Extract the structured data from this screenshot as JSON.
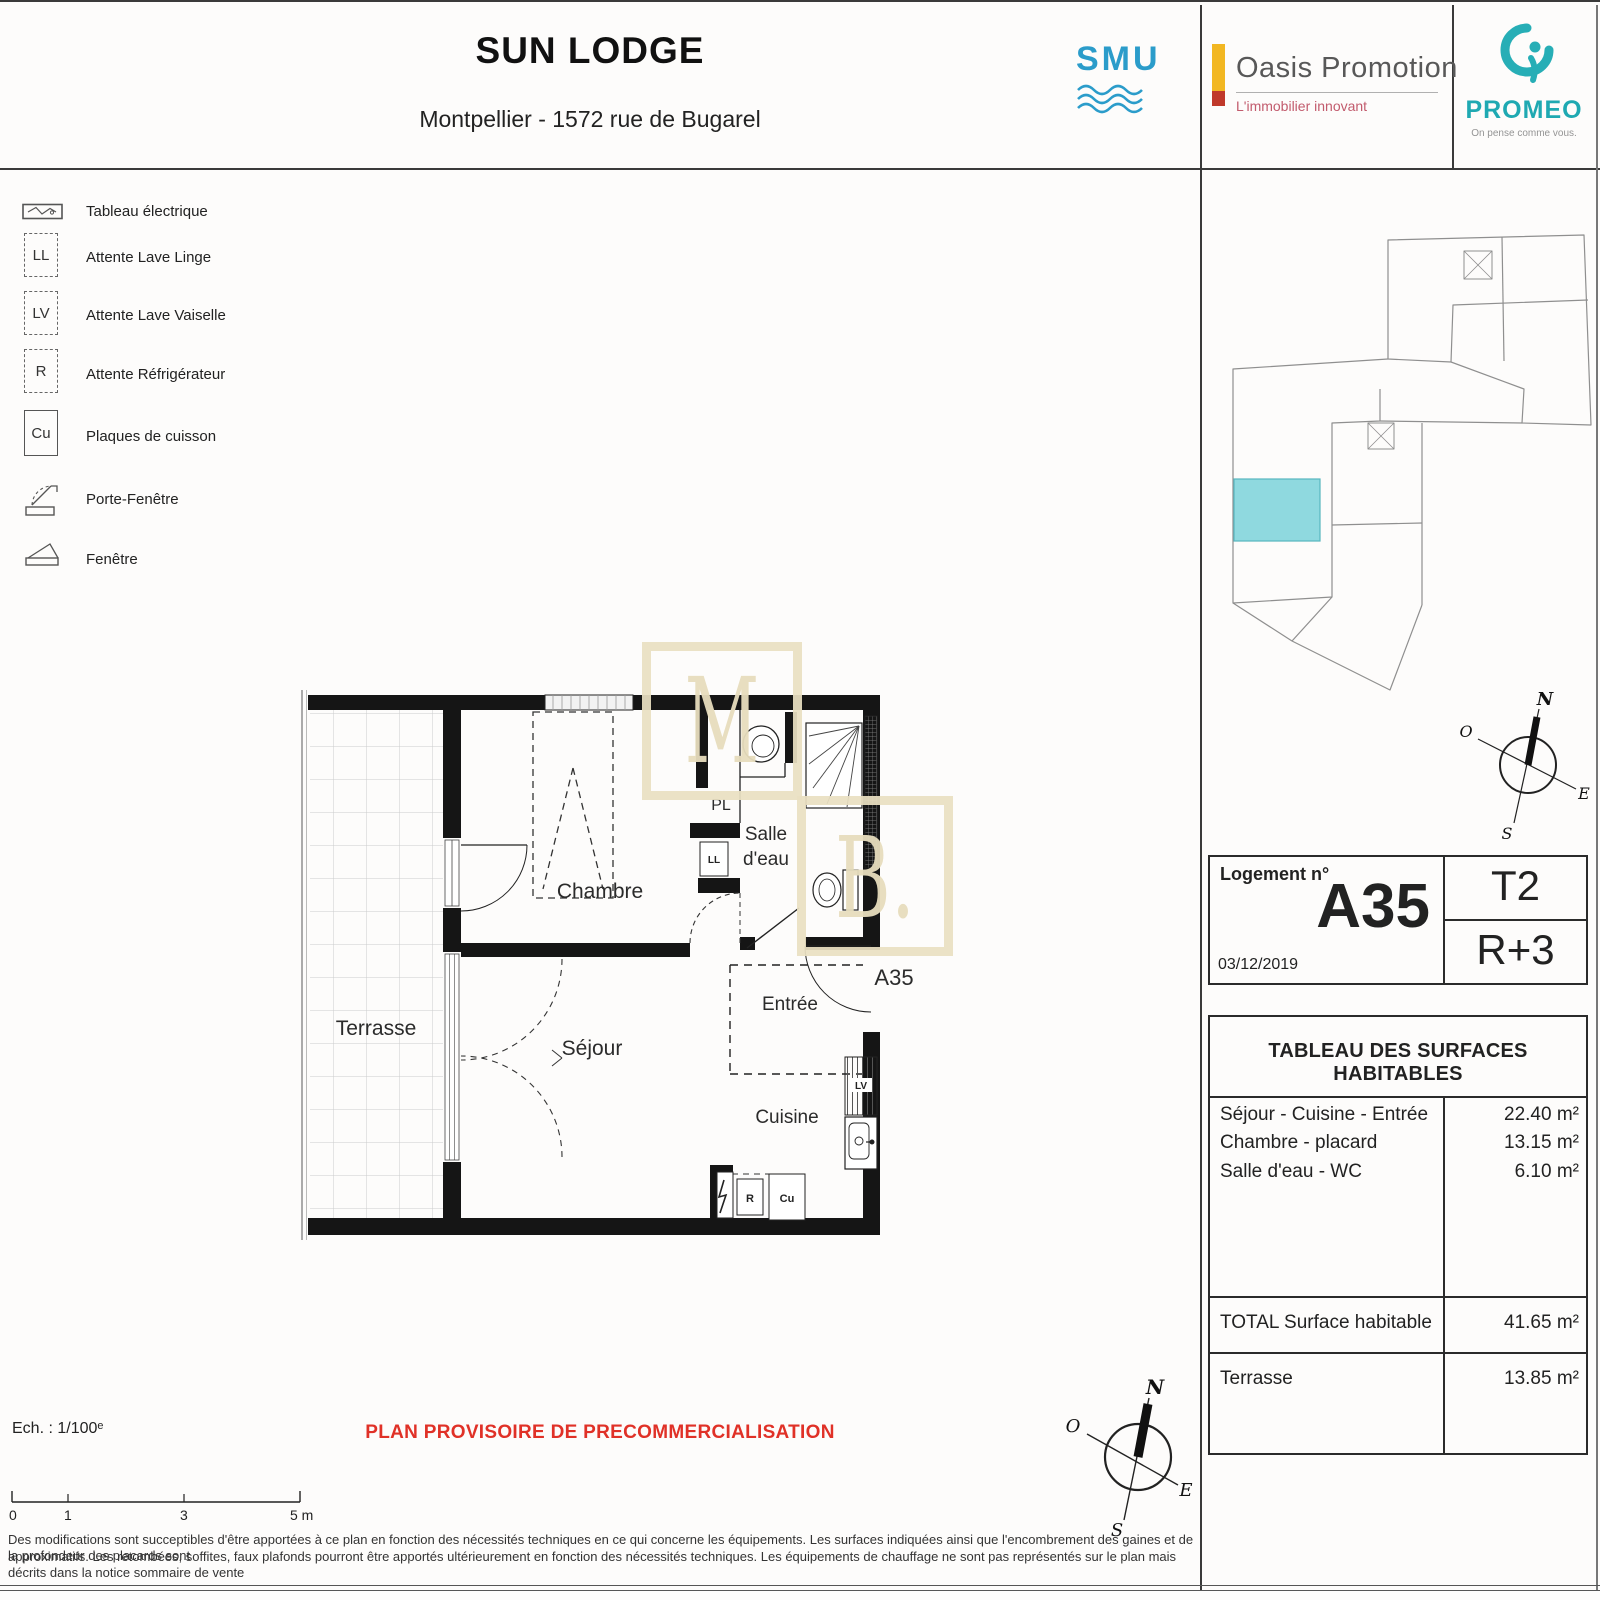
{
  "header": {
    "title": "SUN LODGE",
    "subtitle": "Montpellier  - 1572 rue de Bugarel"
  },
  "logos": {
    "smu": {
      "text": "SMU"
    },
    "oasis": {
      "name": "Oasis Promotion",
      "tagline": "L'immobilier innovant"
    },
    "promeo": {
      "name": "PROMEO",
      "tagline": "On pense comme vous."
    }
  },
  "legend": {
    "items": [
      {
        "box": "",
        "label": "Tableau électrique"
      },
      {
        "box": "LL",
        "label": "Attente Lave Linge"
      },
      {
        "box": "LV",
        "label": "Attente Lave Vaiselle"
      },
      {
        "box": "R",
        "label": "Attente Réfrigérateur"
      },
      {
        "box": "Cu",
        "label": "Plaques de cuisson"
      },
      {
        "box": "",
        "label": "Porte-Fenêtre"
      },
      {
        "box": "",
        "label": "Fenêtre"
      }
    ]
  },
  "plan": {
    "rooms": {
      "terrasse": "Terrasse",
      "chambre": "Chambre",
      "sejour": "Séjour",
      "salle_eau_line1": "Salle",
      "salle_eau_line2": "d'eau",
      "entree": "Entrée",
      "cuisine": "Cuisine",
      "placard": "PL",
      "unit": "A35"
    },
    "appliances": {
      "ll": "LL",
      "lv": "LV",
      "r": "R",
      "cu": "Cu"
    }
  },
  "watermark": {
    "top_letter": "M",
    "bottom_letter": "B."
  },
  "compass": {
    "n": "N",
    "s": "S",
    "e": "E",
    "o": "O"
  },
  "footer": {
    "scale_label": "Ech. : 1/100ᵉ",
    "scale_ticks": [
      "0",
      "1",
      "3",
      "5 m"
    ],
    "notice": "PLAN PROVISOIRE DE PRECOMMERCIALISATION",
    "disclaimer_line1": "Des modifications sont succeptibles d'être apportées à ce plan en fonction des nécessités techniques en ce qui concerne les équipements. Les surfaces indiquées ainsi que l'encombrement des gaines et de la profondeur des placards sont",
    "disclaimer_line2": "approximatifs. Les retombées, soffites, faux plafonds pourront être apportés ultérieurement en fonction des nécessités techniques. Les équipements de chauffage ne sont pas représentés sur le plan mais décrits dans la notice sommaire de vente"
  },
  "unit_box": {
    "label": "Logement n°",
    "number": "A35",
    "date": "03/12/2019",
    "type": "T2",
    "floor": "R+3"
  },
  "surface_table": {
    "title": "TABLEAU DES SURFACES HABITABLES",
    "rows": [
      {
        "label": "Séjour - Cuisine - Entrée",
        "value": "22.40 m²"
      },
      {
        "label": "Chambre - placard",
        "value": "13.15 m²"
      },
      {
        "label": "Salle d'eau - WC",
        "value": "6.10 m²"
      }
    ],
    "total": {
      "label": "TOTAL Surface habitable",
      "value": "41.65 m²"
    },
    "terrace": {
      "label": "Terrasse",
      "value": "13.85 m²"
    }
  },
  "colors": {
    "accent_cyan": "#8fd9df",
    "notice_red": "#e03127",
    "smu_blue": "#2b9cca",
    "promeo_teal": "#1fa9b2",
    "oasis_yellow": "#f2b722",
    "oasis_red": "#c0392b",
    "watermark_beige": "#eae0c2"
  }
}
